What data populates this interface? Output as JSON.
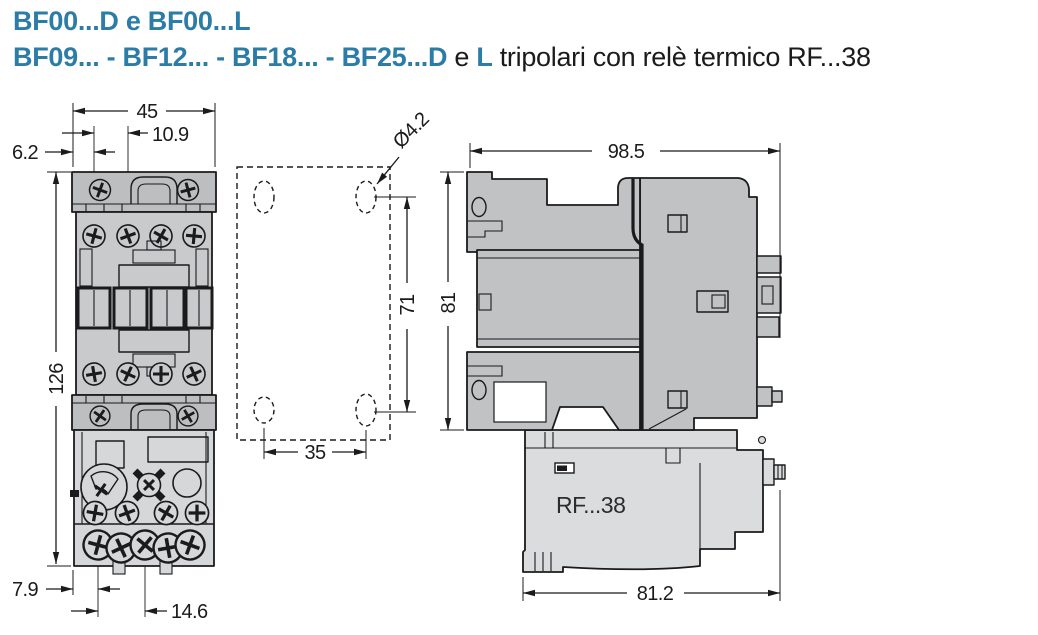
{
  "title": {
    "line1": "BF00...D e BF00...L",
    "line2_blue1": "BF09... - BF12... - BF18... - BF25...D",
    "line2_black1": " e ",
    "line2_blue2": "L",
    "line2_black2": " tripolari con relè termico RF...38"
  },
  "front_view": {
    "dims": {
      "overall_width": "45",
      "coil_terminal_offset": "10.9",
      "edge_offset": "6.2",
      "overall_height": "126",
      "bottom_edge_offset": "7.9",
      "terminal_pitch": "14.6"
    }
  },
  "mounting_plan": {
    "dims": {
      "hole_diameter": "Ø4.2",
      "vertical_hole_pitch": "71",
      "horizontal_hole_pitch": "35"
    }
  },
  "side_view": {
    "relay_label": "RF...38",
    "dims": {
      "overall_depth": "98.5",
      "contactor_height": "81",
      "relay_depth": "81.2"
    }
  },
  "colors": {
    "accent_blue": "#2b7ca7",
    "line_black": "#1b1b1d",
    "body_gray": "#c9cacc",
    "cap_gray": "#bdbec0",
    "relay_front_gray": "#d6d7d9",
    "side_body_gray": "#c1c2c4",
    "side_relay_gray": "#dbdcde"
  }
}
